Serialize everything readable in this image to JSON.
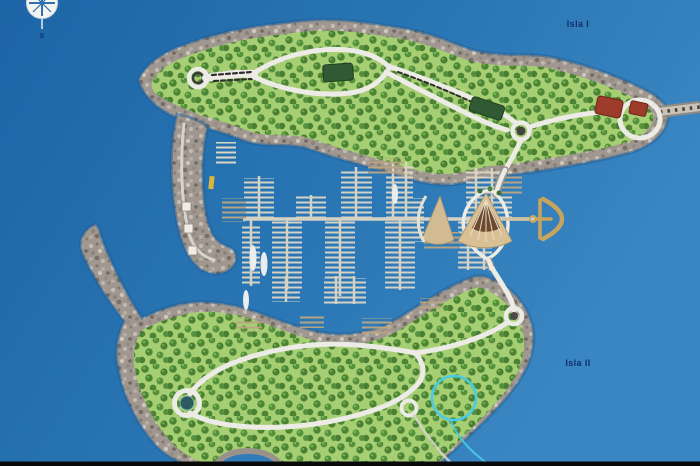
{
  "labels": {
    "island_top": "Isla I",
    "island_bottom": "Isla II",
    "compass_south": "S"
  },
  "palette": {
    "water_deep": "#1d65a6",
    "water_mid": "#2a76b4",
    "water_light": "#3a87c3",
    "land_green": "#a6cf74",
    "tree_green": "#4c8434",
    "rock_gray": "#a09890",
    "road_white": "#ecebe5",
    "dock_light": "#dcd6c4",
    "dock_tan": "#bba583",
    "building_green": "#2f5a34",
    "building_red": "#9e3c2c",
    "gold_anchor": "#c9a45c",
    "annotation_cyan": "#49cbe4",
    "label_navy": "#10306a",
    "pond_teal": "#2b5a60",
    "boat_white": "#f2f2ee",
    "edge_black": "#0a0a0a"
  }
}
